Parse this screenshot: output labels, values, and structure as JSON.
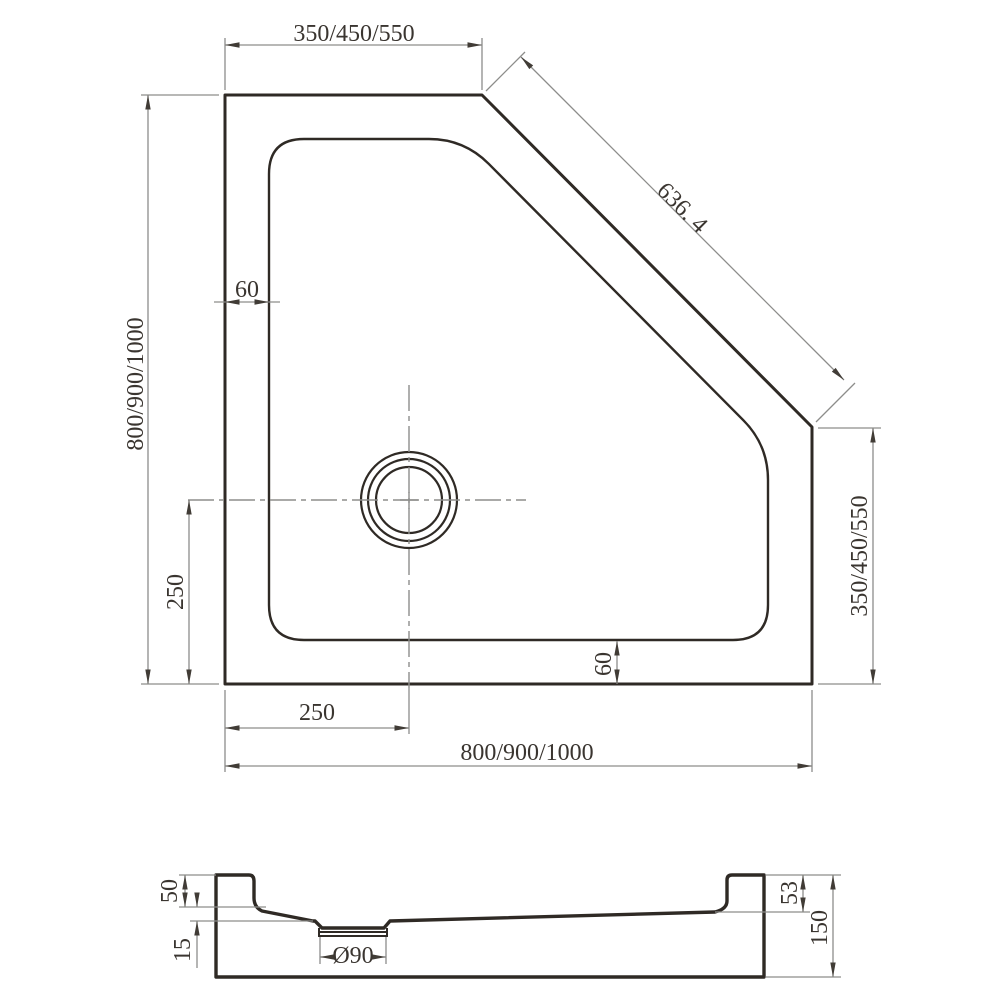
{
  "drawing_type": "shower-tray-technical-drawing",
  "colors": {
    "background": "#ffffff",
    "outline": "#2f2a25",
    "dimension_lines": "#8d8d8b",
    "text": "#3a3530"
  },
  "top_view": {
    "width_top": "350/450/550",
    "diagonal": "636. 4",
    "height_left": "800/900/1000",
    "height_right": "350/450/550",
    "width_bottom": "800/900/1000",
    "wall_thickness_top": "60",
    "wall_thickness_bottom": "60",
    "drain_offset_horizontal": "250",
    "drain_offset_vertical": "250"
  },
  "section_view": {
    "rim_height": "50",
    "floor_drop": "15",
    "drain_diameter": "Ø90",
    "inner_depth_right": "53",
    "total_height": "150"
  }
}
